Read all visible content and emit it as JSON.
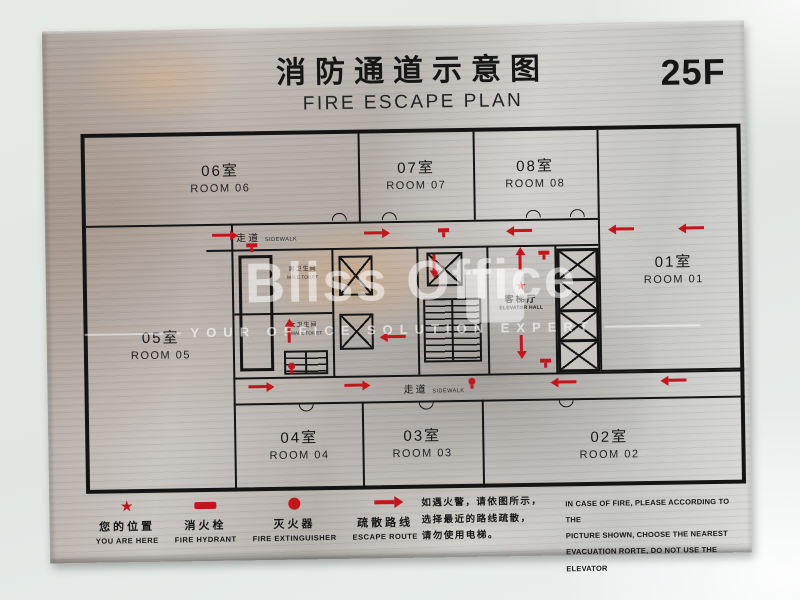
{
  "sign": {
    "title_cn": "消防通道示意图",
    "title_en": "FIRE ESCAPE PLAN",
    "floor": "25F"
  },
  "plan": {
    "rooms": [
      {
        "cn": "06室",
        "en": "ROOM 06"
      },
      {
        "cn": "07室",
        "en": "ROOM 07"
      },
      {
        "cn": "08室",
        "en": "ROOM 08"
      },
      {
        "cn": "01室",
        "en": "ROOM 01"
      },
      {
        "cn": "05室",
        "en": "ROOM 05"
      },
      {
        "cn": "04室",
        "en": "ROOM 04"
      },
      {
        "cn": "03室",
        "en": "ROOM 03"
      },
      {
        "cn": "02室",
        "en": "ROOM 02"
      }
    ],
    "corridor": {
      "cn": "走道",
      "en": "SIDEWALK"
    },
    "core": {
      "male_toilet_cn": "男卫生间",
      "male_toilet_en": "MALE TOILET",
      "female_toilet_cn": "女卫生间",
      "female_toilet_en": "FEMALE TOILET",
      "elevator_hall_cn": "客梯厅",
      "elevator_hall_en": "ELEVATOR HALL"
    }
  },
  "legend": [
    {
      "symbol": "star",
      "cn": "您的位置",
      "en": "YOU ARE HERE"
    },
    {
      "symbol": "hydrant-bar",
      "cn": "消火栓",
      "en": "FIRE HYDRANT"
    },
    {
      "symbol": "extinguisher-dot",
      "cn": "灭火器",
      "en": "FIRE EXTINGUISHER"
    },
    {
      "symbol": "arrow",
      "cn": "疏散路线",
      "en": "ESCAPE ROUTE"
    }
  ],
  "notice": {
    "cn_lines": [
      "如遇火警，请依图所示，",
      "选择最近的路线疏散，",
      "请勿使用电梯。"
    ],
    "en_lines": [
      "IN CASE OF FIRE, PLEASE ACCORDING TO THE",
      "PICTURE SHOWN, CHOOSE THE NEAREST",
      "EVACUATION RORTE, DO NOT USE THE ELEVATOR"
    ]
  },
  "watermark": {
    "brand": "Bliss Office",
    "tagline": "YOUR OFFICE SOLUTION EXPERT"
  },
  "symbols": {
    "star": "★"
  },
  "colors": {
    "accent_red": "#c3161c",
    "plate_text": "#161616"
  }
}
